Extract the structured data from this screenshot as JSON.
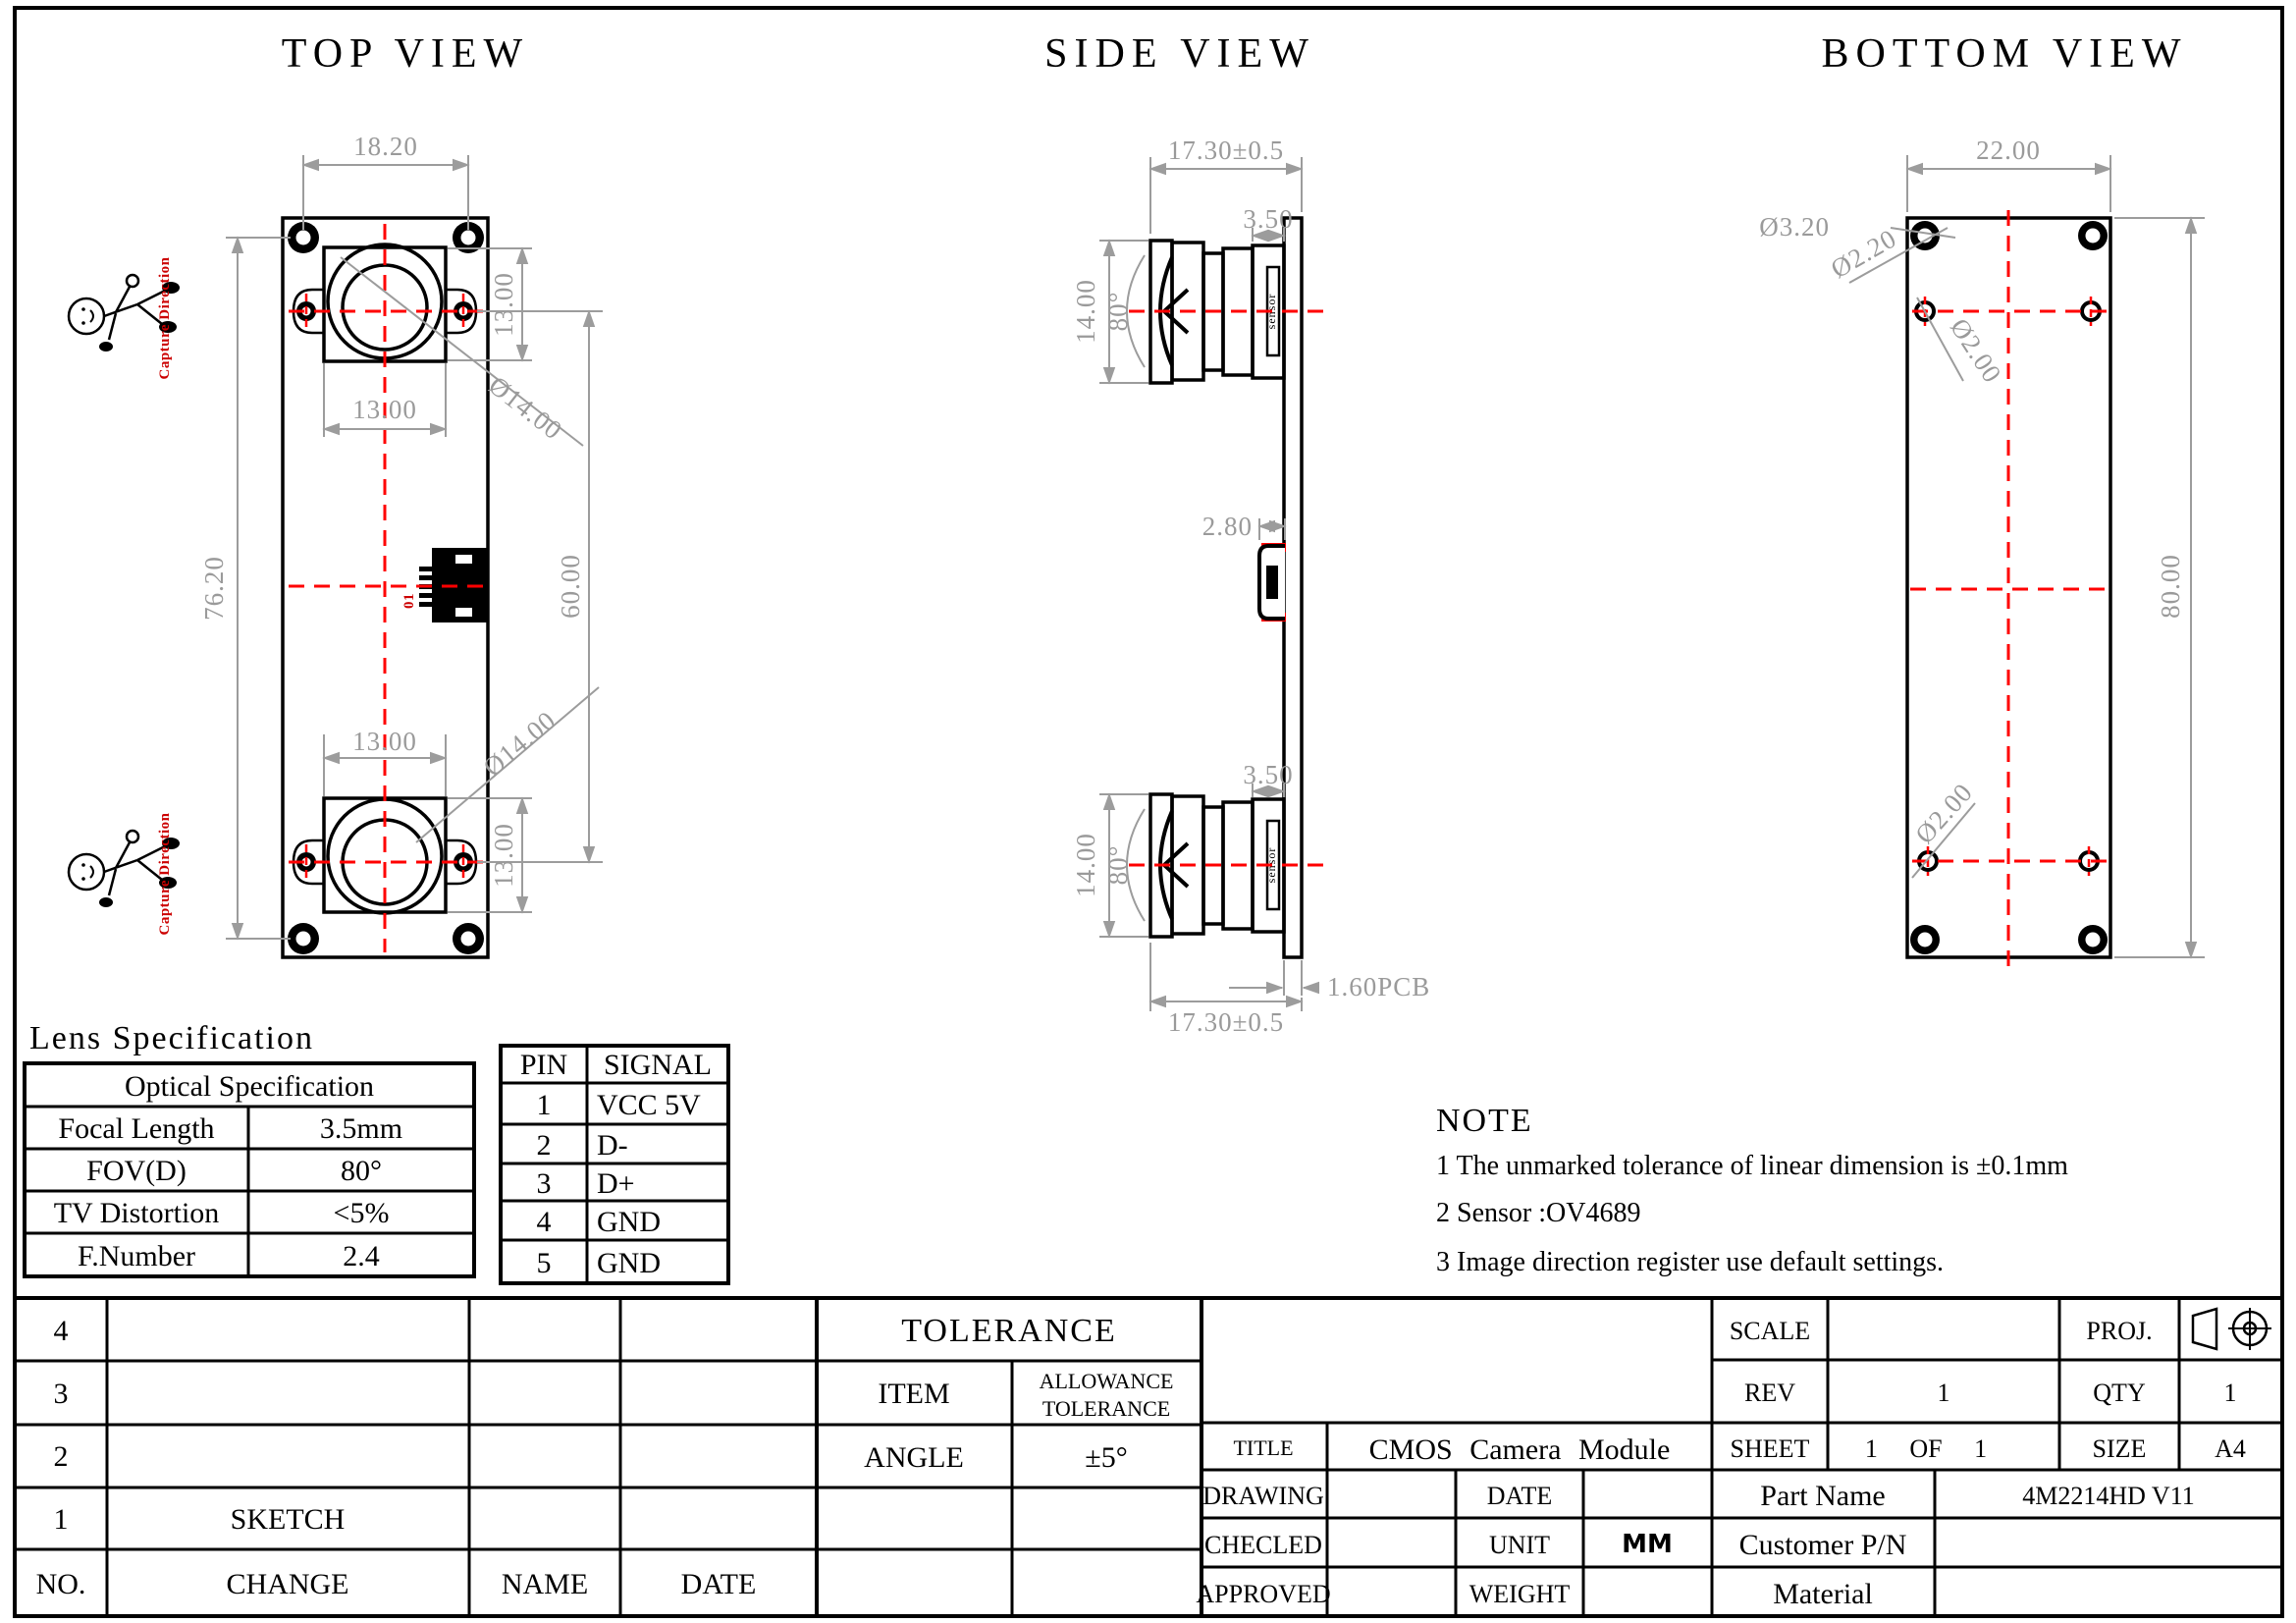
{
  "drawing": {
    "top_view": {
      "title": "TOP VIEW",
      "capture_direction": "Capture Direction",
      "usb_ref": "01",
      "dim_width": "18.20",
      "dim_cam1_w": "13.00",
      "dim_cam1_h": "13.00",
      "dim_lens1": "Ø14.00",
      "dim_board_h": "76.20",
      "dim_spacing": "60.00",
      "dim_cam2_w": "13.00",
      "dim_lens2": "Ø14.00",
      "dim_cam2_h": "13.00"
    },
    "side_view": {
      "title": "SIDE VIEW",
      "sensor_label": "sensor",
      "dim_depth_top": "17.30±0.5",
      "dim_lens1_len": "3.50",
      "dim_cam1_h": "14.00",
      "fov1": "80°",
      "dim_usb": "2.80",
      "dim_lens2_len": "3.50",
      "dim_cam2_h": "14.00",
      "fov2": "80°",
      "dim_pcb": "1.60PCB",
      "dim_depth_bottom": "17.30±0.5"
    },
    "bottom_view": {
      "title": "BOTTOM VIEW",
      "dim_width": "22.00",
      "dim_hole_pad": "Ø3.20",
      "dim_hole_drill": "Ø2.20",
      "dim_hole_top": "Ø2.00",
      "dim_hole_bottom": "Ø2.00",
      "dim_board_h": "80.00"
    }
  },
  "lens_spec": {
    "section_title": "Lens Specification",
    "header": "Optical Specification",
    "rows": [
      [
        "Focal Length",
        "3.5mm"
      ],
      [
        "FOV(D)",
        "80°"
      ],
      [
        "TV Distortion",
        "<5%"
      ],
      [
        "F.Number",
        "2.4"
      ]
    ]
  },
  "pin_table": {
    "headers": [
      "PIN",
      "SIGNAL"
    ],
    "rows": [
      [
        "1",
        "VCC 5V"
      ],
      [
        "2",
        "D-"
      ],
      [
        "3",
        "D+"
      ],
      [
        "4",
        "GND"
      ],
      [
        "5",
        "GND"
      ]
    ]
  },
  "note": {
    "title": "NOTE",
    "items": [
      "1  The unmarked tolerance of linear dimension is ±0.1mm",
      "2  Sensor :OV4689",
      "3  Image direction register use default settings."
    ]
  },
  "title_block": {
    "rows": [
      "4",
      "3",
      "2",
      "1"
    ],
    "sketch": "SKETCH",
    "no_label": "NO.",
    "change_label": "CHANGE",
    "name_label": "NAME",
    "date_label": "DATE",
    "tolerance_title": "TOLERANCE",
    "item_label": "ITEM",
    "allowance_line1": "ALLOWANCE",
    "allowance_line2": "TOLERANCE",
    "angle_label": "ANGLE",
    "angle_value": "±5°",
    "scale_label": "SCALE",
    "proj_label": "PROJ.",
    "rev_label": "REV",
    "rev_value": "1",
    "qty_label": "QTY",
    "qty_value": "1",
    "title_label": "TITLE",
    "title_value": "CMOS Camera Module",
    "sheet_label": "SHEET",
    "sheet_value": "1 OF 1",
    "size_label": "SIZE",
    "size_value": "A4",
    "drawing_label": "DRAWING",
    "date2_label": "DATE",
    "part_name_label": "Part Name",
    "part_name_value": "4M2214HD V11",
    "checked_label": "CHECLED",
    "unit_label": "UNIT",
    "unit_value": "MM",
    "customer_pn_label": "Customer P/N",
    "approved_label": "APPROVED",
    "weight_label": "WEIGHT",
    "material_label": "Material"
  }
}
